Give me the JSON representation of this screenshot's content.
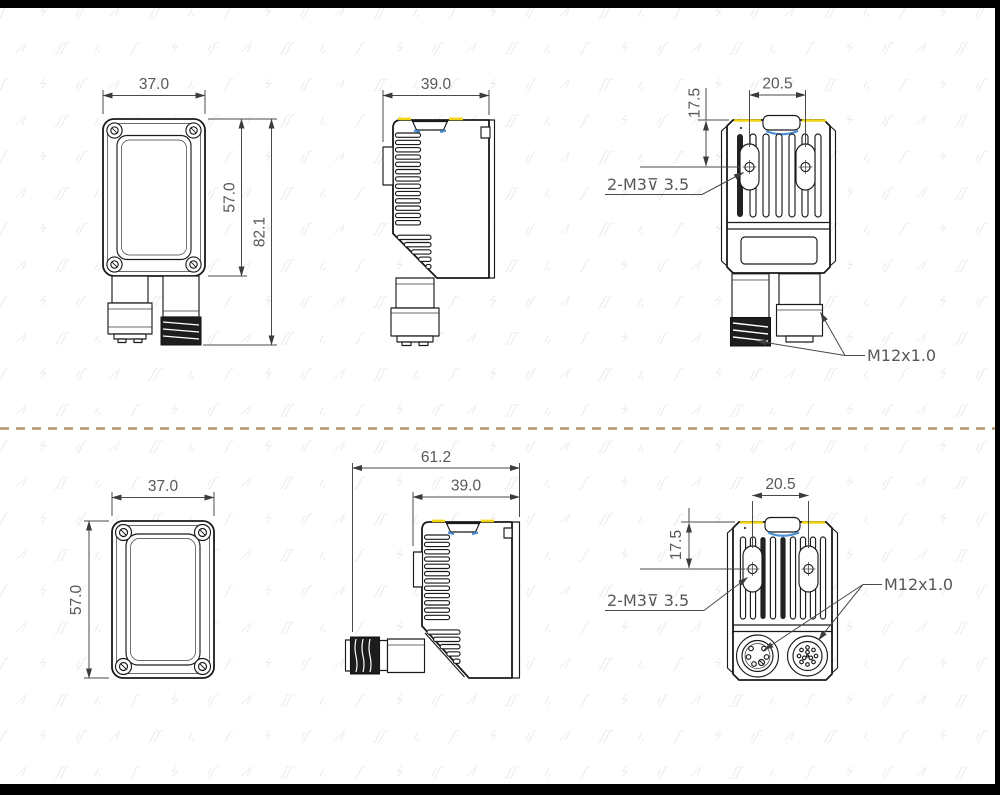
{
  "drawing_title": "sensor-dimension-drawing",
  "dims": {
    "top_front": {
      "width": "37.0",
      "body_height": "57.0",
      "total_height": "82.1"
    },
    "top_side": {
      "depth": "39.0"
    },
    "top_rear": {
      "hole_spacing": "20.5",
      "hole_offset": "17.5",
      "tap_label": "2-M3⊽ 3.5",
      "connector_label": "M12x1.0"
    },
    "bottom_front": {
      "width": "37.0",
      "height": "57.0"
    },
    "bottom_side": {
      "total_depth": "61.2",
      "body_depth": "39.0"
    },
    "bottom_rear": {
      "hole_spacing": "20.5",
      "hole_offset": "17.5",
      "tap_label": "2-M3⊽ 3.5",
      "connector_label": "M12x1.0"
    }
  },
  "divider": {
    "style": "dashed",
    "color": "#b5956a"
  },
  "frame": {
    "bar_color": "#000000"
  },
  "colors": {
    "line": "#1a1a1a",
    "dim_text": "#585858",
    "accent_yellow": "#f2d410",
    "accent_blue": "#4b8fd4"
  },
  "watermark": {
    "glyphs": [
      "ʃ",
      "ϟ",
      "ıʃ",
      "⁄ı",
      "ʃʃ",
      "ı,"
    ],
    "color": "#ececec"
  }
}
